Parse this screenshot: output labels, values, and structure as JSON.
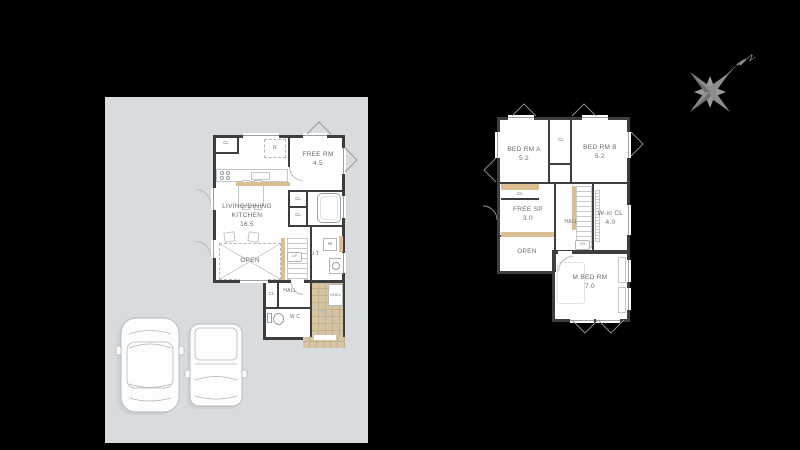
{
  "compass": {
    "north_label": "N"
  },
  "colors": {
    "background": "#000000",
    "site_plot": "#d8dcde",
    "wall": "#3e3e3e",
    "accent_beige": "#dcbe93",
    "entry_tile": "#d6c5a2",
    "tile_line": "#c3b28d",
    "outline_gray": "#b2b7ba",
    "label_gray": "#6a6a6a",
    "compass_gray": "#8d8d8d"
  },
  "floor1": {
    "labels": {
      "cl_kitchen": "CL",
      "fridge": "R",
      "free_room_name": "FREE RM",
      "free_room_size": "4.5",
      "ldk_line1": "LIVING/DINING",
      "ldk_line2": "KITCHEN",
      "ldk_size": "16.5",
      "cl_upper": "CL",
      "cl_lower": "CL",
      "washer": "W",
      "utility": "U T",
      "stairs_up": "UP",
      "open": "OPEN",
      "hall": "HALL",
      "cl_hall": "CL",
      "wc": "W C",
      "shoe_closet": "SHCL"
    }
  },
  "floor2": {
    "labels": {
      "bed_a_name": "BED RM A",
      "bed_a_size": "5.2",
      "cl_mid": "CL",
      "bed_b_name": "BED RM B",
      "bed_b_size": "5.2",
      "cl_a": "CL",
      "free_sp_name": "FREE SP",
      "free_sp_size": "3.0",
      "hall": "HALL",
      "stairs_dn": "DN",
      "wicl_name": "W-in CL",
      "wicl_size": "4.0",
      "open": "OPEN",
      "mbed_name": "M BED RM",
      "mbed_size": "7.0"
    }
  }
}
